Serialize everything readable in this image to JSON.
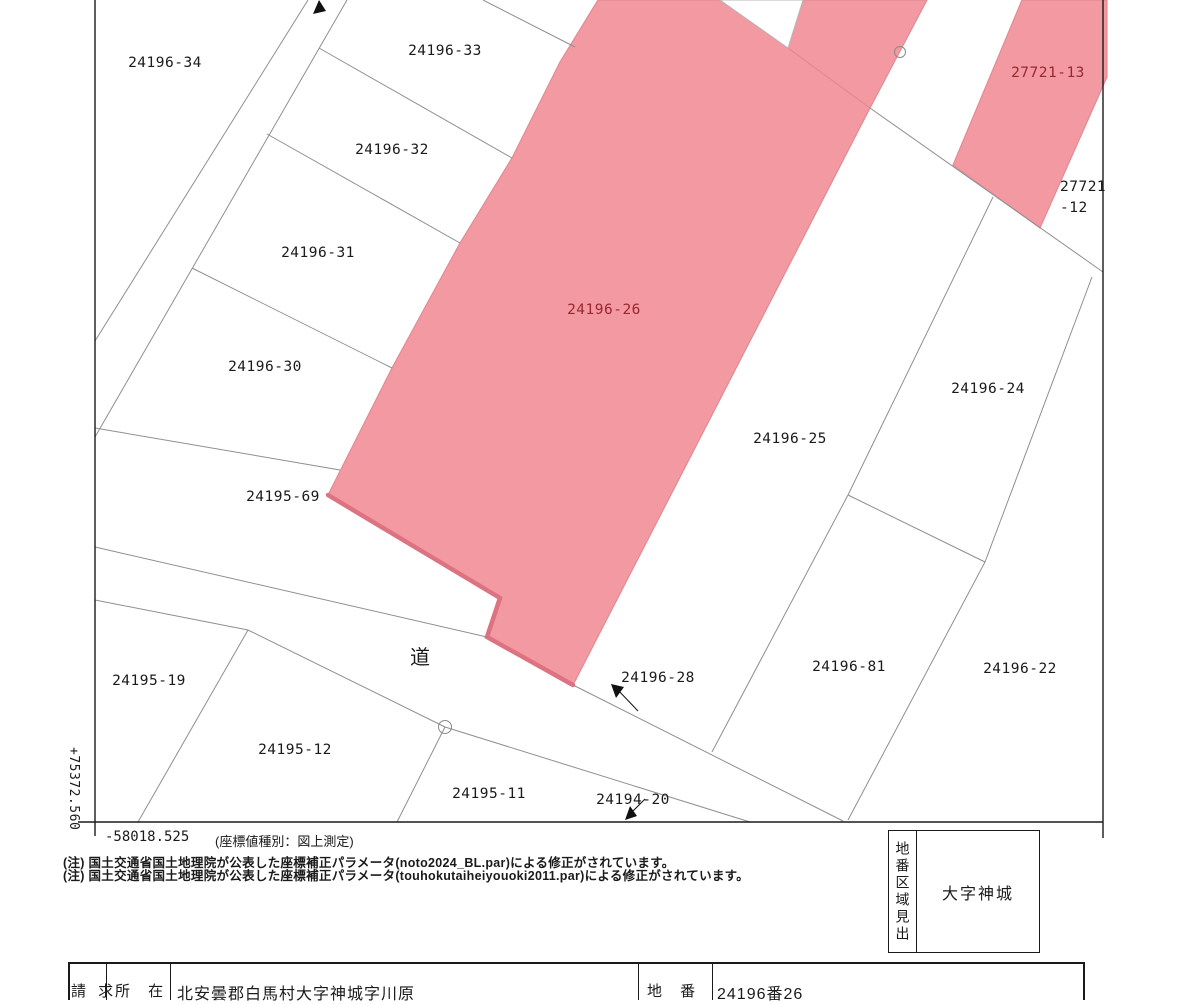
{
  "colors": {
    "highlight_fill": "#F399A1",
    "highlight_edge": "#E18B94",
    "highlight_edge_thick": "#DD7380",
    "highlight_text": "#99272F",
    "boundary_line": "#8f8f8f",
    "frame": "#1a1a1a",
    "text": "#1a1a1a"
  },
  "labels": {
    "p24196_34": "24196-34",
    "p24196_33": "24196-33",
    "p24196_32": "24196-32",
    "p24196_31": "24196-31",
    "p24196_30": "24196-30",
    "p24195_69": "24195-69",
    "p24196_26": "24196-26",
    "p24196_25": "24196-25",
    "p24196_24": "24196-24",
    "p24196_28": "24196-28",
    "p24196_81": "24196-81",
    "p24196_22": "24196-22",
    "p24195_19": "24195-19",
    "p24195_12": "24195-12",
    "p24195_11": "24195-11",
    "p24194_20": "24194-20",
    "p27721_13": "27721-13",
    "p27721_12_line1": "27721",
    "p27721_12_line2": "-12",
    "road": "道"
  },
  "axis": {
    "x_value": "-58018.525",
    "y_value": "+75372.560",
    "type_note": "(座標値種別：図上測定)"
  },
  "notes": {
    "line1": "(注) 国土交通省国土地理院が公表した座標補正パラメータ(noto2024_BL.par)による修正がされています。",
    "line2": "(注) 国土交通省国土地理院が公表した座標補正パラメータ(touhokutaiheiyouoki2011.par)による修正がされています。"
  },
  "legend_box": {
    "heading": "地番区域見出",
    "value": "大字神城"
  },
  "request_table": {
    "request_label": "請 求",
    "location_label": "所 在",
    "location_value": "北安曇郡白馬村大字神城字川原",
    "parcel_label": "地 番",
    "parcel_value": "24196番26"
  }
}
